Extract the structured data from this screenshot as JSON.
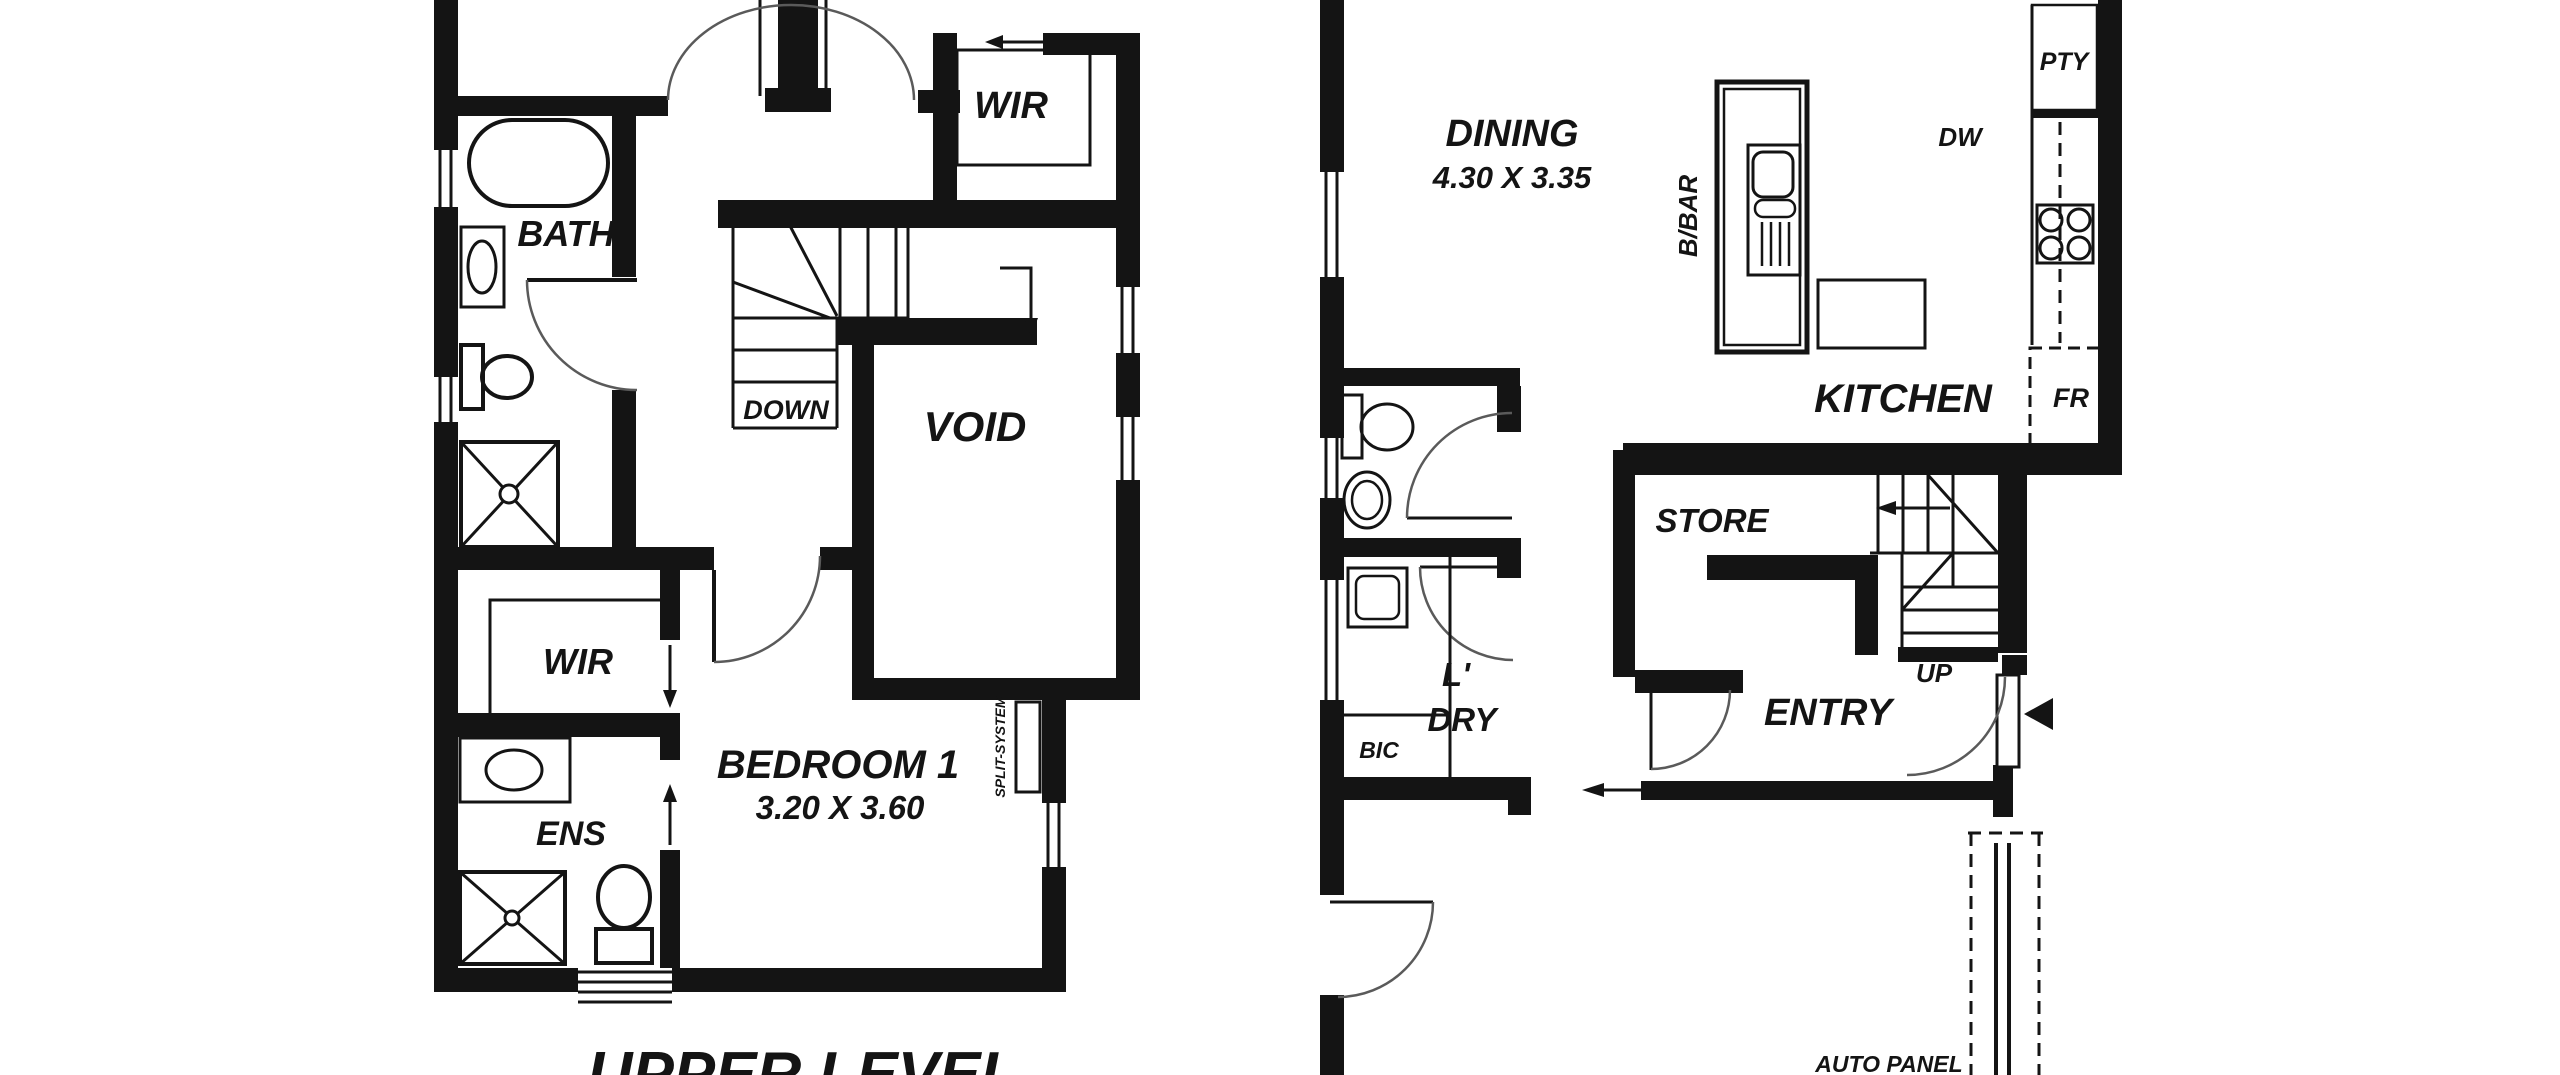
{
  "colors": {
    "ink": "#141414",
    "paper": "#ffffff"
  },
  "upper_level": {
    "title": "UPPER LEVEL",
    "bath": "BATH",
    "wir_top": "WIR",
    "down": "DOWN",
    "void": "VOID",
    "wir_lower": "WIR",
    "ens": "ENS",
    "bedroom1_name": "BEDROOM 1",
    "bedroom1_dims": "3.20 X 3.60",
    "split_system": "SPLIT-SYSTEM"
  },
  "ground_level": {
    "dining_name": "DINING",
    "dining_dims": "4.30 X 3.35",
    "bbar": "B/BAR",
    "dw": "DW",
    "pty": "PTY",
    "kitchen": "KITCHEN",
    "fr": "FR",
    "store": "STORE",
    "up": "UP",
    "entry": "ENTRY",
    "laundry_line1": "L'",
    "laundry_line2": "DRY",
    "bic": "BIC",
    "auto_panel": "AUTO PANEL"
  }
}
